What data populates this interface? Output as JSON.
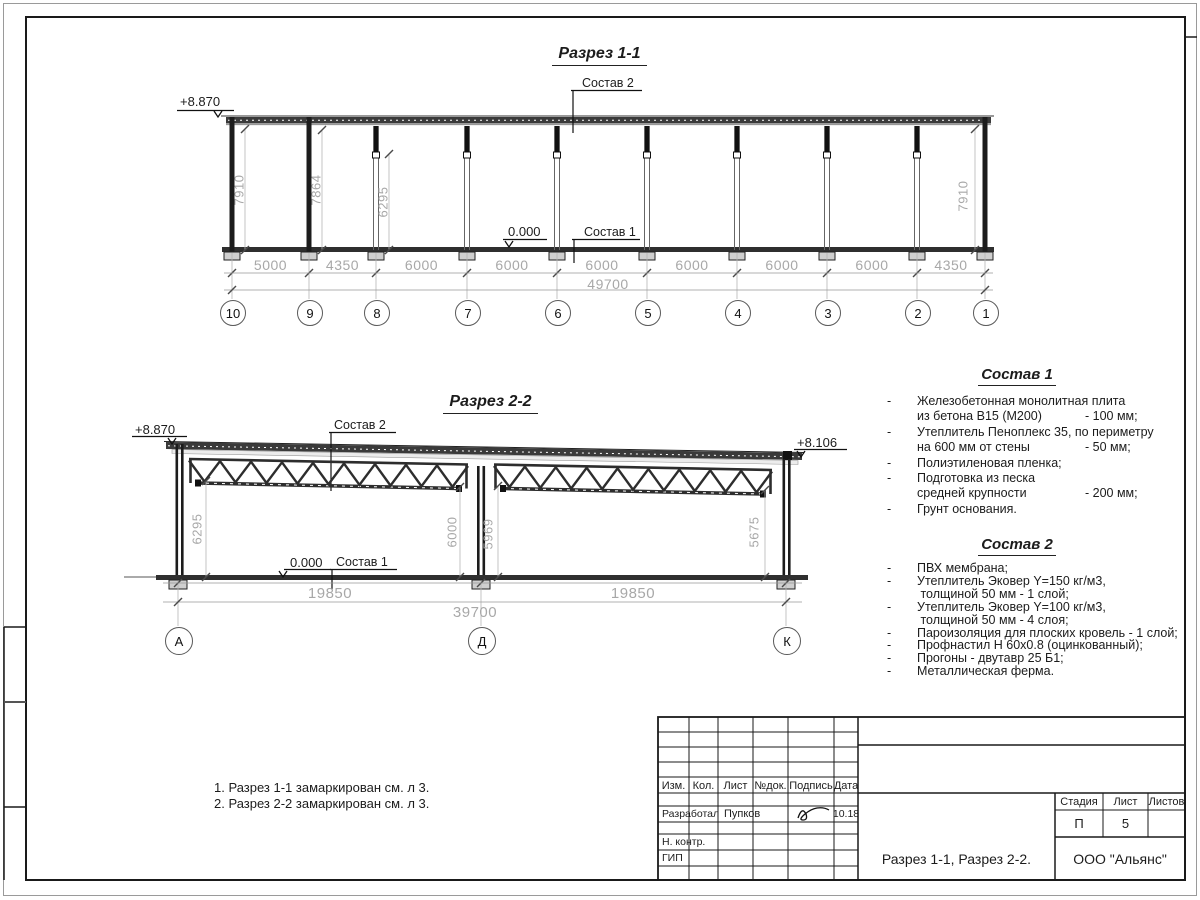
{
  "sheet": {
    "section1": {
      "title": "Разрез 1-1",
      "elevation_top": "+8.870",
      "elevation_zero": "0.000",
      "callout_roof": "Состав 2",
      "callout_floor": "Состав 1",
      "heights": [
        "7910",
        "7864",
        "6295",
        "7910"
      ],
      "segment_dims": [
        "5000",
        "4350",
        "6000",
        "6000",
        "6000",
        "6000",
        "6000",
        "6000",
        "4350"
      ],
      "total_dim": "49700",
      "grid_labels": [
        "10",
        "9",
        "8",
        "7",
        "6",
        "5",
        "4",
        "3",
        "2",
        "1"
      ]
    },
    "section2": {
      "title": "Разрез 2-2",
      "elevation_left": "+8.870",
      "elevation_right": "+8.106",
      "elevation_zero": "0.000",
      "callout_roof": "Состав 2",
      "callout_floor": "Состав 1",
      "heights": [
        "6295",
        "6000",
        "5969",
        "5675"
      ],
      "segment_dims": [
        "19850",
        "19850"
      ],
      "total_dim": "39700",
      "grid_labels": [
        "А",
        "Д",
        "К"
      ]
    },
    "composition1": {
      "title": "Состав 1",
      "items": [
        {
          "dash": "-",
          "text": "Железобетонная  монолитная плита",
          "value": ""
        },
        {
          "dash": "",
          "text": "из бетона В15 (М200)",
          "value": "- 100 мм;"
        },
        {
          "dash": "-",
          "text": "Утеплитель Пеноплекс 35, по периметру",
          "value": ""
        },
        {
          "dash": "",
          "text": "на 600 мм от стены",
          "value": "- 50 мм;"
        },
        {
          "dash": "-",
          "text": "Полиэтиленовая пленка;",
          "value": ""
        },
        {
          "dash": "-",
          "text": "Подготовка из песка",
          "value": ""
        },
        {
          "dash": "",
          "text": "средней крупности",
          "value": "- 200 мм;"
        },
        {
          "dash": "-",
          "text": "Грунт основания.",
          "value": ""
        }
      ]
    },
    "composition2": {
      "title": "Состав 2",
      "items": [
        {
          "dash": "-",
          "text": "ПВХ мембрана;",
          "value": ""
        },
        {
          "dash": "-",
          "text": "Утеплитель Эковер Y=150 кг/м3,",
          "value": ""
        },
        {
          "dash": "",
          "text": " толщиной 50 мм - 1 слой;",
          "value": ""
        },
        {
          "dash": "-",
          "text": "Утеплитель Эковер Y=100 кг/м3,",
          "value": ""
        },
        {
          "dash": "",
          "text": " толщиной 50 мм - 4 слоя;",
          "value": ""
        },
        {
          "dash": "-",
          "text": "Пароизоляция для плоских кровель - 1 слой;",
          "value": ""
        },
        {
          "dash": "-",
          "text": "Профнастил Н 60х0.8 (оцинкованный);",
          "value": ""
        },
        {
          "dash": "-",
          "text": "Прогоны - двутавр 25 Б1;",
          "value": ""
        },
        {
          "dash": "-",
          "text": "Металлическая ферма.",
          "value": ""
        }
      ]
    },
    "notes": [
      "1. Разрез 1-1 замаркирован см. л 3.",
      "2. Разрез 2-2 замаркирован см. л 3."
    ],
    "stamp": {
      "header": [
        "Изм.",
        "Кол.",
        "Лист",
        "№док.",
        "Подпись",
        "Дата"
      ],
      "rows": [
        {
          "role": "Разработал",
          "name": "Пупков",
          "date": "10.18"
        },
        {
          "role": "Н. контр."
        },
        {
          "role": "ГИП"
        }
      ],
      "sheet_name": "Разрез 1-1, Разрез 2-2.",
      "org": "ООО \"Альянс\"",
      "stage_header": [
        "Стадия",
        "Лист",
        "Листов"
      ],
      "stage": "П",
      "sheet_no": "5",
      "sheets_total": ""
    },
    "colors": {
      "ink": "#1c1c1c",
      "dim_text": "#a8a8a8",
      "roof_fill": "#3a3a3a"
    }
  }
}
